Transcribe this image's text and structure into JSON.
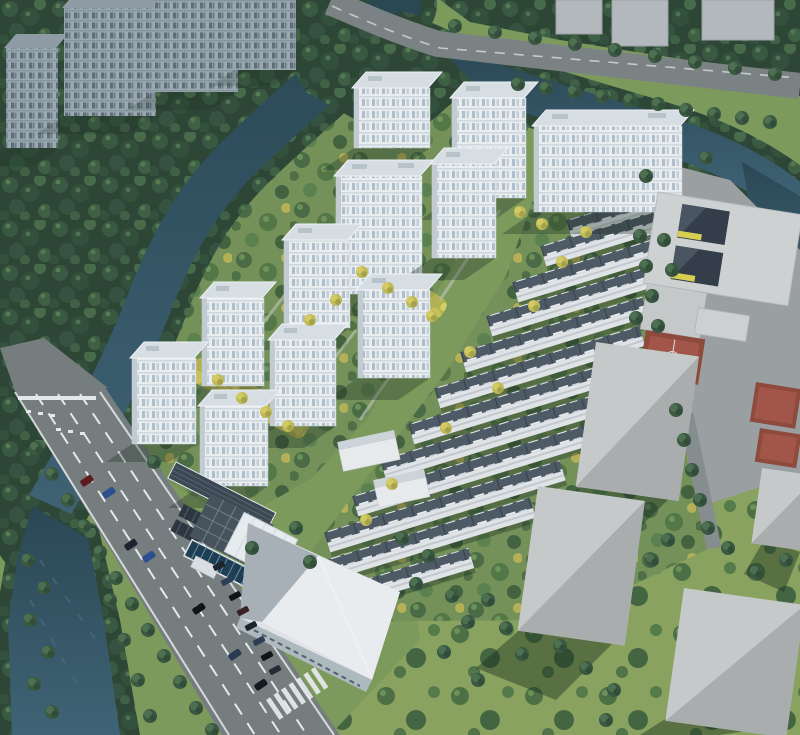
{
  "image": {
    "kind": "aerial-architectural-rendering",
    "subject": "bird's-eye masterplan rendering of a riverside residential development",
    "width_px": 800,
    "height_px": 735,
    "visible_text": ""
  },
  "scene": {
    "development": {
      "white_high_rise_towers": 11,
      "low_rise_amenity_buildings": 2,
      "townhouse_rows": 12,
      "golden_landscape_axes": 2,
      "swimming_pool": 1,
      "solar_canopy": 1,
      "clubhouse": 1
    },
    "context": {
      "muted_neighbor_towers_northwest": 4,
      "gray_slabs_northeast": 3,
      "gray_massing_blocks_southeast": 4,
      "school_building_with_courtyards": 1,
      "red_sports_courts": 3,
      "commercial_building_south": 1
    },
    "landscape": {
      "rivers": 2,
      "pond": 1,
      "forest_zones": 3,
      "street_tree_rows": 6
    },
    "roads": {
      "arterial_southwest_lanes": 4,
      "north_road": 1,
      "east_boundary_road": 1,
      "crosswalks": 1,
      "cars_visible": 15
    }
  },
  "colors": {
    "lawn": "#7d9a5d",
    "lawnBright": "#8aa25f",
    "forest": "#2e4636",
    "river": "#2c4a57",
    "riverLight": "#3f6476",
    "road": "#767d7e",
    "roadLight": "#8a9092",
    "lane": "#e6e9ea",
    "towerFace": "#e9edf0",
    "towerRoof": "#d6dee3",
    "towerSide": "#c2cbd2",
    "mutedTower": "#9aa8b1",
    "mutedRoof": "#8f9ca5",
    "thRoof": "#4e5a66",
    "thWall": "#dfe3e6",
    "massTop": "#c6c9ca",
    "massSide": "#a9adae",
    "plaza": "#9aa0a2",
    "schoolWall": "#ced1d2",
    "notch": "#343e4a",
    "accentYellow": "#d6cf52",
    "courtRed": "#8e4a3c",
    "courtRedLight": "#a2564a",
    "poolBlue": "#1e3e54",
    "solar": "#3c4954",
    "gridRoof": "#46525c",
    "treeGold": "#c2bb5c"
  }
}
